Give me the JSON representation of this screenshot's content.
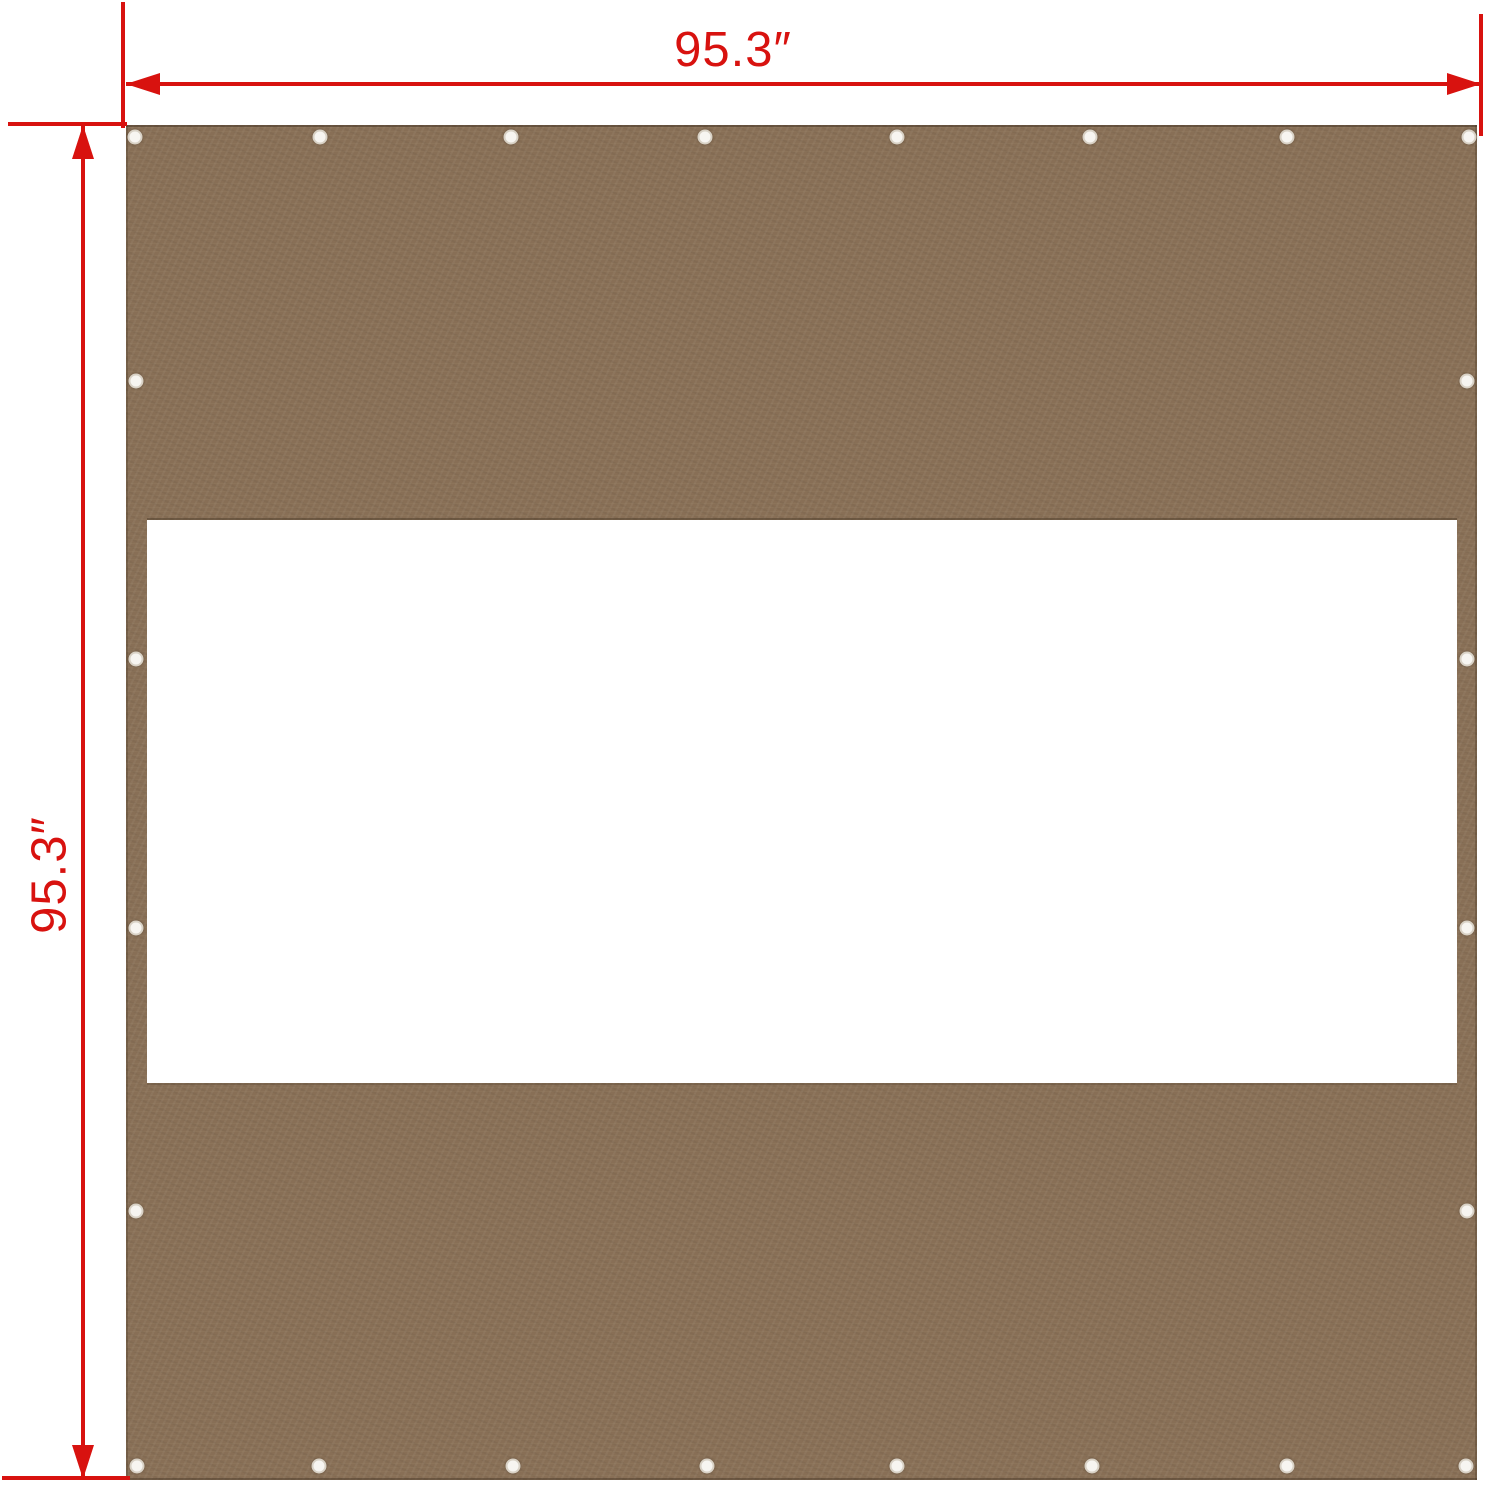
{
  "diagram": {
    "type": "product-dimension-diagram",
    "subject": "gazebo sidewall privacy panel with window cutout",
    "width_label": "95.3″",
    "height_label": "95.3″"
  },
  "colors": {
    "dimension_red": "#d8120f",
    "fabric_brown": "#8a7157",
    "fabric_edge_dark": "#6f5a44",
    "window_white": "#ffffff",
    "grommet_fill": "#f7f5f1",
    "grommet_ring": "#d9d2c6",
    "background": "#ffffff"
  },
  "panel": {
    "grommet_count": 24,
    "grommet_positions": [
      [
        135,
        137
      ],
      [
        320,
        137
      ],
      [
        511,
        137
      ],
      [
        705,
        137
      ],
      [
        897,
        137
      ],
      [
        1090,
        137
      ],
      [
        1287,
        137
      ],
      [
        1469,
        137
      ],
      [
        137,
        1466
      ],
      [
        319,
        1466
      ],
      [
        513,
        1466
      ],
      [
        707,
        1466
      ],
      [
        897,
        1466
      ],
      [
        1092,
        1466
      ],
      [
        1287,
        1466
      ],
      [
        1466,
        1466
      ],
      [
        136,
        381
      ],
      [
        136,
        659
      ],
      [
        136,
        928
      ],
      [
        136,
        1211
      ],
      [
        1467,
        381
      ],
      [
        1467,
        659
      ],
      [
        1467,
        928
      ],
      [
        1467,
        1211
      ]
    ]
  }
}
